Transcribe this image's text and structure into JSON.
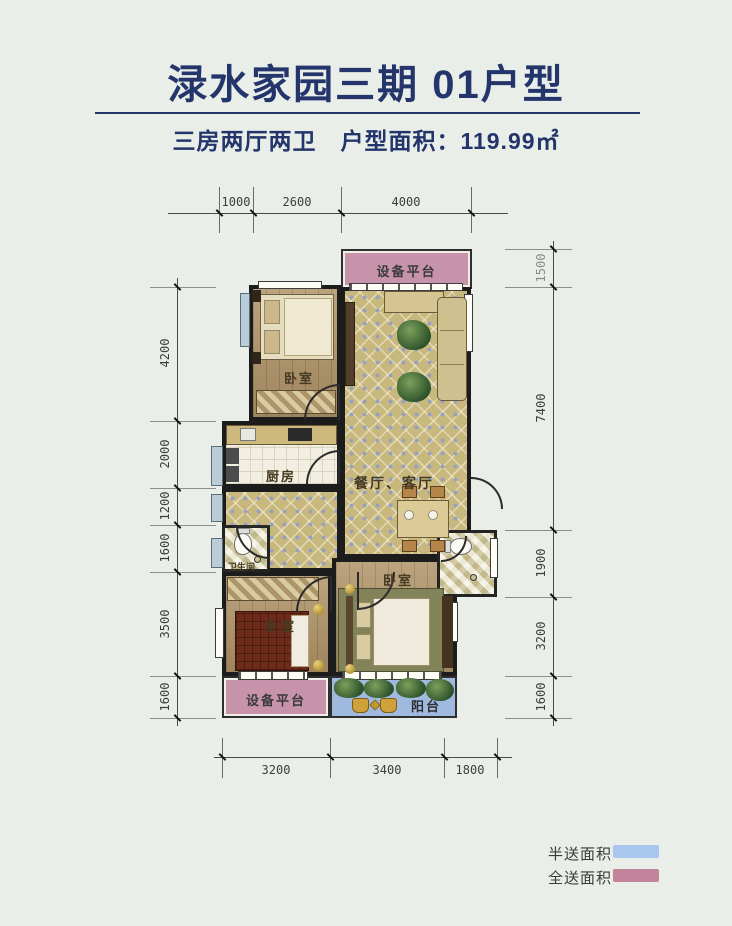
{
  "header": {
    "title": "渌水家园三期 01户型",
    "subtitle": "三房两厅两卫　户型面积：119.99㎡"
  },
  "floor_plan": {
    "rooms": {
      "top_platform": {
        "label": "设备平台"
      },
      "bedroom1": {
        "label": "卧室"
      },
      "living_dining": {
        "label": "餐厅、客厅"
      },
      "kitchen": {
        "label": "厨房"
      },
      "bathroom1": {
        "label": "卫生间"
      },
      "bedroom2": {
        "label": "卧室"
      },
      "master_bedroom": {
        "label": "卧室"
      },
      "bottom_platform": {
        "label": "设备平台"
      },
      "balcony": {
        "label": "阳台"
      }
    },
    "dimensions": {
      "top": [
        "1000",
        "2600",
        "4000"
      ],
      "left": [
        "4200",
        "2000",
        "1200",
        "1600",
        "3500",
        "1600"
      ],
      "right": [
        "1500",
        "7400",
        "1900",
        "3200",
        "1600"
      ],
      "bottom": [
        "3200",
        "3400",
        "1800"
      ]
    }
  },
  "legend": {
    "items": [
      {
        "label": "半送面积",
        "color": "#a9c6ee"
      },
      {
        "label": "全送面积",
        "color": "#c2839b"
      }
    ]
  },
  "colors": {
    "title_navy": "#23356b",
    "full_gift_pink": "#c793aa",
    "half_gift_blue": "#9fbade",
    "floor_tile": "#c9b87e",
    "wood_floor": "#b09468",
    "wall": "#1c1c1c",
    "background": "#e9eee9"
  }
}
